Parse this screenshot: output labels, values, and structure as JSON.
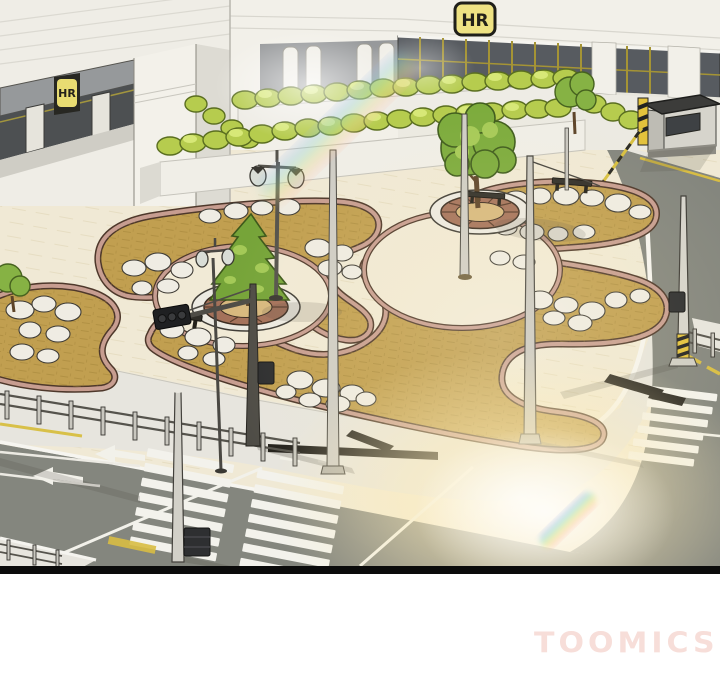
{
  "panel": {
    "building_sign_main": "HR",
    "building_sign_entrance": "HR"
  },
  "watermark": {
    "text": "TOOMICS",
    "color": "#f7ded9"
  },
  "palette": {
    "building_wall": "#f1efe8",
    "window_glass": "#575b60",
    "window_frame_gold": "#a59435",
    "sign_yellow": "#eee283",
    "hedge_green": "#b6cc4e",
    "tree_green": "#7cab3c",
    "plaza_paving": "#f0e9d5",
    "garden_gravel": "#c19f50",
    "garden_border": "#c79d90",
    "rock_white": "#efece3",
    "road_asphalt": "#85877f",
    "marking_white": "#f2f1ea",
    "marking_yellow": "#d8bd44",
    "glow_warm": "#ffeebb",
    "panel_border": "#0b0b0b"
  }
}
